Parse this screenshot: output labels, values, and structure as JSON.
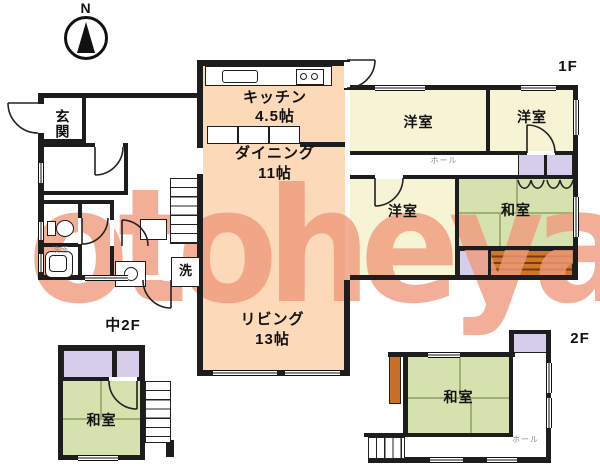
{
  "watermark": "otoheya",
  "compass": {
    "label": "N"
  },
  "floor_labels": {
    "f1": "1F",
    "m2": "中2F",
    "f2": "2F"
  },
  "f1": {
    "genkan": "玄関",
    "kitchen": {
      "name": "キッチン",
      "size": "4.5帖"
    },
    "dining": {
      "name": "ダイニング",
      "size": "11帖"
    },
    "living": {
      "name": "リビング",
      "size": "13帖"
    },
    "western_rooms": [
      "洋室",
      "洋室",
      "洋室"
    ],
    "washitsu": "和室",
    "hall": "ホール",
    "laundry": "洗",
    "washroom": "洗面"
  },
  "m2": {
    "washitsu": "和室"
  },
  "f2": {
    "washitsu": "和室",
    "hall": "ホール"
  },
  "colors": {
    "ldk_fill": "#fbd9b9",
    "western_room_fill": "#f6f4d5",
    "tatami_fill": "#d5e2af",
    "closet_fill": "#d6cdeb",
    "veranda_fill": "#d07828",
    "watermark": "#f09a7c",
    "wall": "#1d1d1d"
  }
}
